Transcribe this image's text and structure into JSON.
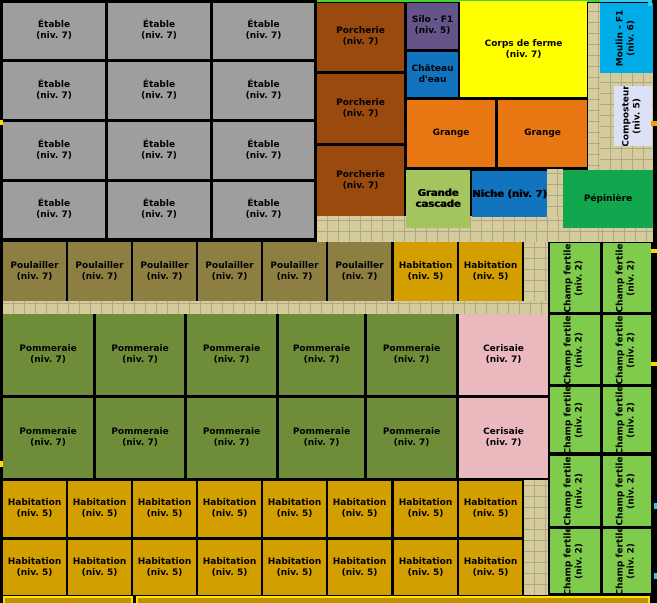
{
  "map": {
    "width": 657,
    "height": 603,
    "background": "#000000"
  },
  "palette": {
    "etable": "#9E9E9E",
    "porcherie": "#9A4A0F",
    "silo": "#64548A",
    "eau": "#1273BE",
    "corps": "#FFFF00",
    "moulin": "#00ACE8",
    "composteur": "#DDE1F6",
    "grange": "#E87613",
    "cascade": "#A4C45D",
    "pepiniere": "#12A64F",
    "poulailler": "#8C7F41",
    "habitation": "#D39E00",
    "pommeraie": "#6F8C38",
    "cerisaie": "#EAB9BD",
    "champ": "#7FCB4C",
    "path_fill": "#D5CC9D"
  },
  "path_regions": [
    {
      "x": 317,
      "y": 216,
      "w": 336,
      "h": 26
    },
    {
      "x": 588,
      "y": 3,
      "w": 12,
      "h": 239
    },
    {
      "x": 600,
      "y": 73,
      "w": 53,
      "h": 97
    },
    {
      "x": 547,
      "y": 169,
      "w": 16,
      "h": 48
    },
    {
      "x": 524,
      "y": 242,
      "w": 24,
      "h": 71
    },
    {
      "x": 524,
      "y": 480,
      "w": 24,
      "h": 115
    },
    {
      "x": 3,
      "y": 301,
      "w": 545,
      "h": 13
    }
  ],
  "blocks": [
    {
      "name": "etable",
      "lines": [
        "Étable",
        "(niv. 7)"
      ],
      "fill": "etable",
      "x": 3,
      "y": 3,
      "w": 102,
      "h": 56
    },
    {
      "name": "etable",
      "lines": [
        "Étable",
        "(niv. 7)"
      ],
      "fill": "etable",
      "x": 108,
      "y": 3,
      "w": 102,
      "h": 56
    },
    {
      "name": "etable",
      "lines": [
        "Étable",
        "(niv. 7)"
      ],
      "fill": "etable",
      "x": 213,
      "y": 3,
      "w": 101,
      "h": 56
    },
    {
      "name": "etable",
      "lines": [
        "Étable",
        "(niv. 7)"
      ],
      "fill": "etable",
      "x": 3,
      "y": 62,
      "w": 102,
      "h": 57
    },
    {
      "name": "etable",
      "lines": [
        "Étable",
        "(niv. 7)"
      ],
      "fill": "etable",
      "x": 108,
      "y": 62,
      "w": 102,
      "h": 57
    },
    {
      "name": "etable",
      "lines": [
        "Étable",
        "(niv. 7)"
      ],
      "fill": "etable",
      "x": 213,
      "y": 62,
      "w": 101,
      "h": 57
    },
    {
      "name": "etable",
      "lines": [
        "Étable",
        "(niv. 7)"
      ],
      "fill": "etable",
      "x": 3,
      "y": 122,
      "w": 102,
      "h": 57
    },
    {
      "name": "etable",
      "lines": [
        "Étable",
        "(niv. 7)"
      ],
      "fill": "etable",
      "x": 108,
      "y": 122,
      "w": 102,
      "h": 57
    },
    {
      "name": "etable",
      "lines": [
        "Étable",
        "(niv. 7)"
      ],
      "fill": "etable",
      "x": 213,
      "y": 122,
      "w": 101,
      "h": 57
    },
    {
      "name": "etable",
      "lines": [
        "Étable",
        "(niv. 7)"
      ],
      "fill": "etable",
      "x": 3,
      "y": 182,
      "w": 102,
      "h": 56
    },
    {
      "name": "etable",
      "lines": [
        "Étable",
        "(niv. 7)"
      ],
      "fill": "etable",
      "x": 108,
      "y": 182,
      "w": 102,
      "h": 56
    },
    {
      "name": "etable",
      "lines": [
        "Étable",
        "(niv. 7)"
      ],
      "fill": "etable",
      "x": 213,
      "y": 182,
      "w": 101,
      "h": 56
    },
    {
      "name": "porcherie",
      "lines": [
        "Porcherie",
        "(niv. 7)"
      ],
      "fill": "porcherie",
      "x": 317,
      "y": 3,
      "w": 87,
      "h": 68
    },
    {
      "name": "porcherie",
      "lines": [
        "Porcherie",
        "(niv. 7)"
      ],
      "fill": "porcherie",
      "x": 317,
      "y": 74,
      "w": 87,
      "h": 69
    },
    {
      "name": "porcherie",
      "lines": [
        "Porcherie",
        "(niv. 7)"
      ],
      "fill": "porcherie",
      "x": 317,
      "y": 146,
      "w": 87,
      "h": 70
    },
    {
      "name": "silo-f1",
      "lines": [
        "Silo - F1",
        "(niv. 5)"
      ],
      "fill": "silo",
      "x": 407,
      "y": 3,
      "w": 51,
      "h": 46
    },
    {
      "name": "chateau-eau",
      "lines": [
        "Château",
        "d'eau"
      ],
      "fill": "eau",
      "x": 407,
      "y": 52,
      "w": 51,
      "h": 45
    },
    {
      "name": "corps-de-ferme",
      "lines": [
        "Corps de ferme",
        "(niv. 7)"
      ],
      "fill": "corps",
      "x": 460,
      "y": 3,
      "w": 127,
      "h": 94
    },
    {
      "name": "grange",
      "lines": [
        "Grange"
      ],
      "fill": "grange",
      "x": 407,
      "y": 100,
      "w": 88,
      "h": 67
    },
    {
      "name": "grange",
      "lines": [
        "Grange"
      ],
      "fill": "grange",
      "x": 498,
      "y": 100,
      "w": 89,
      "h": 67
    },
    {
      "name": "moulin-f1",
      "lines": [
        "Moulin - F1",
        "(niv. 6)"
      ],
      "fill": "moulin",
      "x": 600,
      "y": 3,
      "w": 53,
      "h": 70,
      "dir": "v"
    },
    {
      "name": "composteur",
      "lines": [
        "Composteur",
        "(niv. 5)"
      ],
      "fill": "composteur",
      "x": 614,
      "y": 86,
      "w": 38,
      "h": 60,
      "dir": "v"
    },
    {
      "name": "grande-cascade",
      "lines": [
        "Grande",
        "cascade"
      ],
      "fill": "cascade",
      "x": 406,
      "y": 170,
      "w": 64,
      "h": 58,
      "bold": true
    },
    {
      "name": "niche",
      "lines": [
        "Niche (niv. 7)"
      ],
      "fill": "eau",
      "x": 472,
      "y": 171,
      "w": 75,
      "h": 46,
      "bold": true
    },
    {
      "name": "pepiniere",
      "lines": [
        "Pépinière"
      ],
      "fill": "pepiniere",
      "x": 563,
      "y": 170,
      "w": 90,
      "h": 58
    },
    {
      "name": "poulailler",
      "lines": [
        "Poulailler",
        "(niv. 7)"
      ],
      "fill": "poulailler",
      "x": 3,
      "y": 242,
      "w": 63,
      "h": 59
    },
    {
      "name": "poulailler",
      "lines": [
        "Poulailler",
        "(niv. 7)"
      ],
      "fill": "poulailler",
      "x": 68,
      "y": 242,
      "w": 63,
      "h": 59
    },
    {
      "name": "poulailler",
      "lines": [
        "Poulailler",
        "(niv. 7)"
      ],
      "fill": "poulailler",
      "x": 133,
      "y": 242,
      "w": 63,
      "h": 59
    },
    {
      "name": "poulailler",
      "lines": [
        "Poulailler",
        "(niv. 7)"
      ],
      "fill": "poulailler",
      "x": 198,
      "y": 242,
      "w": 63,
      "h": 59
    },
    {
      "name": "poulailler",
      "lines": [
        "Poulailler",
        "(niv. 7)"
      ],
      "fill": "poulailler",
      "x": 263,
      "y": 242,
      "w": 63,
      "h": 59
    },
    {
      "name": "poulailler",
      "lines": [
        "Poulailler",
        "(niv. 7)"
      ],
      "fill": "poulailler",
      "x": 328,
      "y": 242,
      "w": 63,
      "h": 59
    },
    {
      "name": "habitation",
      "lines": [
        "Habitation",
        "(niv. 5)"
      ],
      "fill": "habitation",
      "x": 394,
      "y": 242,
      "w": 63,
      "h": 59
    },
    {
      "name": "habitation",
      "lines": [
        "Habitation",
        "(niv. 5)"
      ],
      "fill": "habitation",
      "x": 459,
      "y": 242,
      "w": 63,
      "h": 59
    },
    {
      "name": "pommeraie",
      "lines": [
        "Pommeraie",
        "(niv. 7)"
      ],
      "fill": "pommeraie",
      "x": 3,
      "y": 314,
      "w": 90,
      "h": 81
    },
    {
      "name": "pommeraie",
      "lines": [
        "Pommeraie",
        "(niv. 7)"
      ],
      "fill": "pommeraie",
      "x": 96,
      "y": 314,
      "w": 88,
      "h": 81
    },
    {
      "name": "pommeraie",
      "lines": [
        "Pommeraie",
        "(niv. 7)"
      ],
      "fill": "pommeraie",
      "x": 187,
      "y": 314,
      "w": 89,
      "h": 81
    },
    {
      "name": "pommeraie",
      "lines": [
        "Pommeraie",
        "(niv. 7)"
      ],
      "fill": "pommeraie",
      "x": 279,
      "y": 314,
      "w": 85,
      "h": 81
    },
    {
      "name": "pommeraie",
      "lines": [
        "Pommeraie",
        "(niv. 7)"
      ],
      "fill": "pommeraie",
      "x": 367,
      "y": 314,
      "w": 89,
      "h": 81
    },
    {
      "name": "cerisaie",
      "lines": [
        "Cerisaie",
        "(niv. 7)"
      ],
      "fill": "cerisaie",
      "x": 459,
      "y": 314,
      "w": 89,
      "h": 81
    },
    {
      "name": "pommeraie",
      "lines": [
        "Pommeraie",
        "(niv. 7)"
      ],
      "fill": "pommeraie",
      "x": 3,
      "y": 398,
      "w": 90,
      "h": 80
    },
    {
      "name": "pommeraie",
      "lines": [
        "Pommeraie",
        "(niv. 7)"
      ],
      "fill": "pommeraie",
      "x": 96,
      "y": 398,
      "w": 88,
      "h": 80
    },
    {
      "name": "pommeraie",
      "lines": [
        "Pommeraie",
        "(niv. 7)"
      ],
      "fill": "pommeraie",
      "x": 187,
      "y": 398,
      "w": 89,
      "h": 80
    },
    {
      "name": "pommeraie",
      "lines": [
        "Pommeraie",
        "(niv. 7)"
      ],
      "fill": "pommeraie",
      "x": 279,
      "y": 398,
      "w": 85,
      "h": 80
    },
    {
      "name": "pommeraie",
      "lines": [
        "Pommeraie",
        "(niv. 7)"
      ],
      "fill": "pommeraie",
      "x": 367,
      "y": 398,
      "w": 89,
      "h": 80
    },
    {
      "name": "cerisaie",
      "lines": [
        "Cerisaie",
        "(niv. 7)"
      ],
      "fill": "cerisaie",
      "x": 459,
      "y": 398,
      "w": 89,
      "h": 80
    },
    {
      "name": "habitation",
      "lines": [
        "Habitation",
        "(niv. 5)"
      ],
      "fill": "habitation",
      "x": 3,
      "y": 481,
      "w": 63,
      "h": 56
    },
    {
      "name": "habitation",
      "lines": [
        "Habitation",
        "(niv. 5)"
      ],
      "fill": "habitation",
      "x": 68,
      "y": 481,
      "w": 63,
      "h": 56
    },
    {
      "name": "habitation",
      "lines": [
        "Habitation",
        "(niv. 5)"
      ],
      "fill": "habitation",
      "x": 133,
      "y": 481,
      "w": 63,
      "h": 56
    },
    {
      "name": "habitation",
      "lines": [
        "Habitation",
        "(niv. 5)"
      ],
      "fill": "habitation",
      "x": 198,
      "y": 481,
      "w": 63,
      "h": 56
    },
    {
      "name": "habitation",
      "lines": [
        "Habitation",
        "(niv. 5)"
      ],
      "fill": "habitation",
      "x": 263,
      "y": 481,
      "w": 63,
      "h": 56
    },
    {
      "name": "habitation",
      "lines": [
        "Habitation",
        "(niv. 5)"
      ],
      "fill": "habitation",
      "x": 328,
      "y": 481,
      "w": 63,
      "h": 56
    },
    {
      "name": "habitation",
      "lines": [
        "Habitation",
        "(niv. 5)"
      ],
      "fill": "habitation",
      "x": 394,
      "y": 481,
      "w": 63,
      "h": 56
    },
    {
      "name": "habitation",
      "lines": [
        "Habitation",
        "(niv. 5)"
      ],
      "fill": "habitation",
      "x": 459,
      "y": 481,
      "w": 63,
      "h": 56
    },
    {
      "name": "habitation",
      "lines": [
        "Habitation",
        "(niv. 5)"
      ],
      "fill": "habitation",
      "x": 3,
      "y": 540,
      "w": 63,
      "h": 55
    },
    {
      "name": "habitation",
      "lines": [
        "Habitation",
        "(niv. 5)"
      ],
      "fill": "habitation",
      "x": 68,
      "y": 540,
      "w": 63,
      "h": 55
    },
    {
      "name": "habitation",
      "lines": [
        "Habitation",
        "(niv. 5)"
      ],
      "fill": "habitation",
      "x": 133,
      "y": 540,
      "w": 63,
      "h": 55
    },
    {
      "name": "habitation",
      "lines": [
        "Habitation",
        "(niv. 5)"
      ],
      "fill": "habitation",
      "x": 198,
      "y": 540,
      "w": 63,
      "h": 55
    },
    {
      "name": "habitation",
      "lines": [
        "Habitation",
        "(niv. 5)"
      ],
      "fill": "habitation",
      "x": 263,
      "y": 540,
      "w": 63,
      "h": 55
    },
    {
      "name": "habitation",
      "lines": [
        "Habitation",
        "(niv. 5)"
      ],
      "fill": "habitation",
      "x": 328,
      "y": 540,
      "w": 63,
      "h": 55
    },
    {
      "name": "habitation",
      "lines": [
        "Habitation",
        "(niv. 5)"
      ],
      "fill": "habitation",
      "x": 394,
      "y": 540,
      "w": 63,
      "h": 55
    },
    {
      "name": "habitation",
      "lines": [
        "Habitation",
        "(niv. 5)"
      ],
      "fill": "habitation",
      "x": 459,
      "y": 540,
      "w": 63,
      "h": 55
    },
    {
      "name": "champ-fertile",
      "lines": [
        "Champ fertile",
        "(niv. 2)"
      ],
      "fill": "champ",
      "x": 550,
      "y": 243,
      "w": 50,
      "h": 69,
      "dir": "v"
    },
    {
      "name": "champ-fertile",
      "lines": [
        "Champ fertile",
        "(niv. 2)"
      ],
      "fill": "champ",
      "x": 603,
      "y": 243,
      "w": 48,
      "h": 69,
      "dir": "v"
    },
    {
      "name": "champ-fertile",
      "lines": [
        "Champ fertile",
        "(niv. 2)"
      ],
      "fill": "champ",
      "x": 550,
      "y": 315,
      "w": 50,
      "h": 69,
      "dir": "v"
    },
    {
      "name": "champ-fertile",
      "lines": [
        "Champ fertile",
        "(niv. 2)"
      ],
      "fill": "champ",
      "x": 603,
      "y": 315,
      "w": 48,
      "h": 69,
      "dir": "v"
    },
    {
      "name": "champ-fertile",
      "lines": [
        "Champ fertile",
        "(niv. 2)"
      ],
      "fill": "champ",
      "x": 550,
      "y": 387,
      "w": 50,
      "h": 65,
      "dir": "v"
    },
    {
      "name": "champ-fertile",
      "lines": [
        "Champ fertile",
        "(niv. 2)"
      ],
      "fill": "champ",
      "x": 603,
      "y": 387,
      "w": 48,
      "h": 65,
      "dir": "v"
    },
    {
      "name": "champ-fertile",
      "lines": [
        "Champ fertile",
        "(niv. 2)"
      ],
      "fill": "champ",
      "x": 550,
      "y": 456,
      "w": 50,
      "h": 70,
      "dir": "v"
    },
    {
      "name": "champ-fertile",
      "lines": [
        "Champ fertile",
        "(niv. 2)"
      ],
      "fill": "champ",
      "x": 603,
      "y": 456,
      "w": 48,
      "h": 70,
      "dir": "v"
    },
    {
      "name": "champ-fertile",
      "lines": [
        "Champ fertile",
        "(niv. 2)"
      ],
      "fill": "champ",
      "x": 550,
      "y": 529,
      "w": 50,
      "h": 64,
      "dir": "v"
    },
    {
      "name": "champ-fertile",
      "lines": [
        "Champ fertile",
        "(niv. 2)"
      ],
      "fill": "champ",
      "x": 603,
      "y": 529,
      "w": 48,
      "h": 64,
      "dir": "v"
    }
  ],
  "decorations": {
    "top_strips": [
      {
        "name": "cutoff-top-green",
        "x": 317,
        "y": 0,
        "w": 283,
        "h": 2,
        "color": "#45D52F"
      },
      {
        "name": "cutoff-top-yellow",
        "x": 460,
        "y": 1,
        "w": 127,
        "h": 2,
        "color": "#FFFF00"
      },
      {
        "name": "cutoff-top-cyan",
        "x": 600,
        "y": 0,
        "w": 51,
        "h": 2,
        "color": "#35C8E8"
      },
      {
        "name": "cutoff-top-notch",
        "x": 648,
        "y": 0,
        "w": 4,
        "h": 6,
        "color": "#35C8E8"
      }
    ],
    "bottom_cutoff_boxes": [
      {
        "name": "cutoff-bottom-box",
        "x": 3,
        "y": 596,
        "w": 130,
        "h": 7
      },
      {
        "name": "cutoff-bottom-box",
        "x": 136,
        "y": 596,
        "w": 514,
        "h": 7
      }
    ],
    "edge_marks": [
      {
        "name": "edge-mark-yellow",
        "x": 0,
        "y": 120,
        "w": 3,
        "h": 5,
        "color": "#FFD800"
      },
      {
        "name": "edge-mark-yellow",
        "x": 0,
        "y": 461,
        "w": 3,
        "h": 6,
        "color": "#FFD800"
      },
      {
        "name": "edge-mark-orange",
        "x": 651,
        "y": 121,
        "w": 6,
        "h": 5,
        "color": "#F0A000"
      },
      {
        "name": "edge-mark-yellow",
        "x": 651,
        "y": 249,
        "w": 6,
        "h": 4,
        "color": "#FFD800"
      },
      {
        "name": "edge-mark-yellow",
        "x": 651,
        "y": 362,
        "w": 6,
        "h": 4,
        "color": "#FFD800"
      },
      {
        "name": "edge-mark-cyan",
        "x": 654,
        "y": 503,
        "w": 3,
        "h": 6,
        "color": "#35C8E8"
      },
      {
        "name": "edge-mark-cyan",
        "x": 654,
        "y": 573,
        "w": 3,
        "h": 6,
        "color": "#35C8E8"
      }
    ]
  }
}
